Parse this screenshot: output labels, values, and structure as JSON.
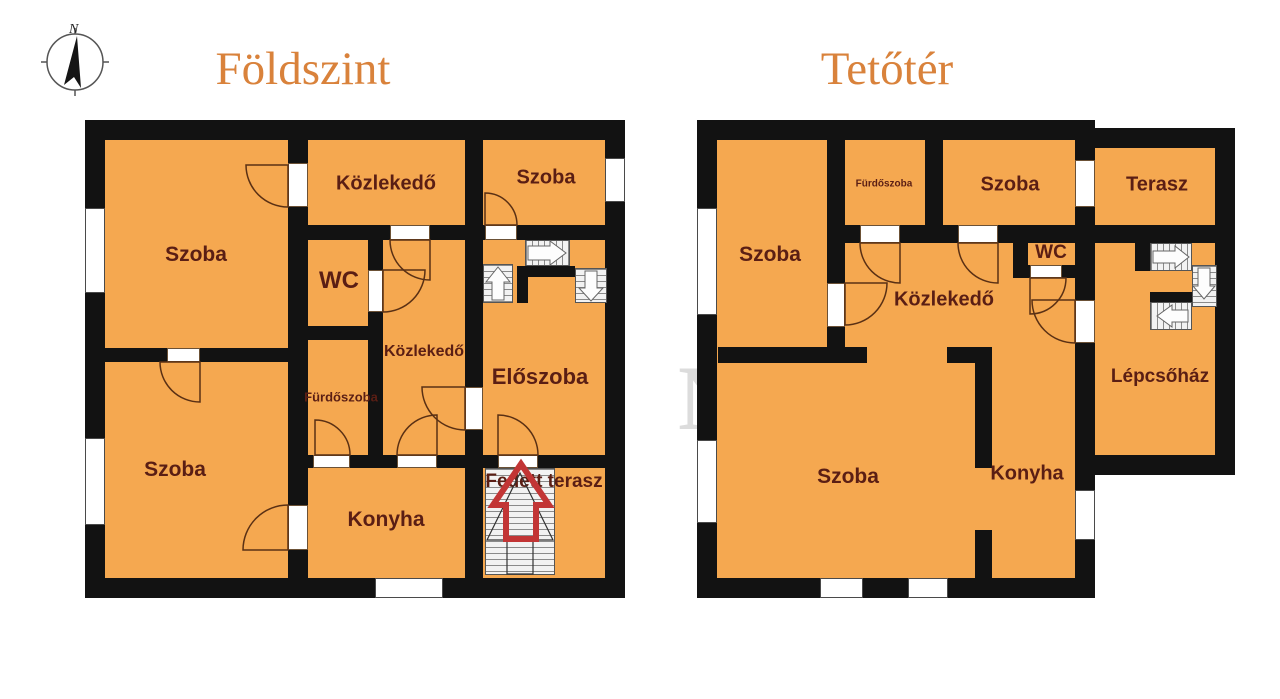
{
  "meta": {
    "background": "#ffffff"
  },
  "colors": {
    "room_fill": "#F5A850",
    "wall": "#121212",
    "label_text": "#5A1E14",
    "title_text": "#D9823B",
    "door_arc": "#5a3014",
    "entrance_arrow": "#C23535",
    "watermark": "#8c8c8c"
  },
  "compass": {
    "label": "N",
    "icon": "north-arrow-compass"
  },
  "watermark": {
    "letter1": "G",
    "letter2": "N"
  },
  "floors": {
    "foldszint": {
      "title": "Földszint",
      "rooms": {
        "szoba_tl": {
          "label": "Szoba"
        },
        "kozlekedo": {
          "label": "Közlekedő"
        },
        "szoba_top": {
          "label": "Szoba"
        },
        "wc": {
          "label": "WC"
        },
        "kozlekedo2": {
          "label": "Közlekedő"
        },
        "furdoszoba": {
          "label": "Fürdőszoba"
        },
        "eloszoba": {
          "label": "Előszoba"
        },
        "szoba_bl": {
          "label": "Szoba"
        },
        "konyha": {
          "label": "Konyha"
        },
        "fedett_terasz": {
          "label": "Fedett terasz"
        }
      }
    },
    "tetoter": {
      "title": "Tetőtér",
      "rooms": {
        "szoba_left": {
          "label": "Szoba"
        },
        "furdoszoba": {
          "label": "Fürdőszoba"
        },
        "szoba_top": {
          "label": "Szoba"
        },
        "terasz": {
          "label": "Terasz"
        },
        "wc": {
          "label": "WC"
        },
        "kozlekedo": {
          "label": "Közlekedő"
        },
        "szoba_big": {
          "label": "Szoba"
        },
        "konyha": {
          "label": "Konyha"
        },
        "lepcsohaz": {
          "label": "Lépcsőház"
        }
      }
    }
  }
}
